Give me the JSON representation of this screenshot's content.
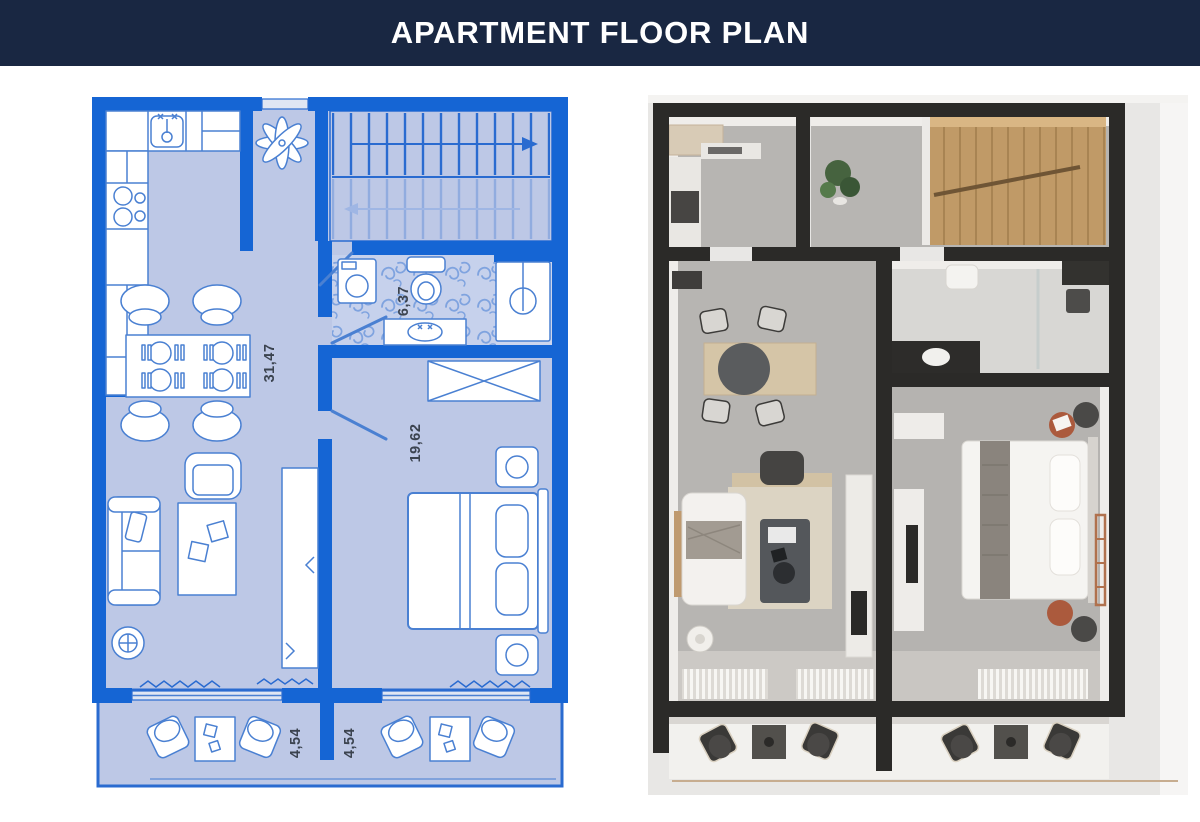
{
  "header": {
    "title": "APARTMENT FLOOR PLAN"
  },
  "colors": {
    "banner_bg": "#192742",
    "banner_text": "#ffffff",
    "blueprint_wall_blue": "#1565d4",
    "blueprint_floor": "#bdc8e6",
    "blueprint_outline": "#4a80d2",
    "render_wall_dark": "#2b2a28",
    "render_floor_gray": "#b7b5b2",
    "render_wood": "#c09a67",
    "render_accent_rust": "#ab5a3d"
  },
  "blueprint_plan": {
    "area_labels": {
      "living": "31,47",
      "bedroom": "19,62",
      "bathroom": "6,37",
      "balcony_left": "4,54",
      "balcony_right": "4,54"
    }
  }
}
